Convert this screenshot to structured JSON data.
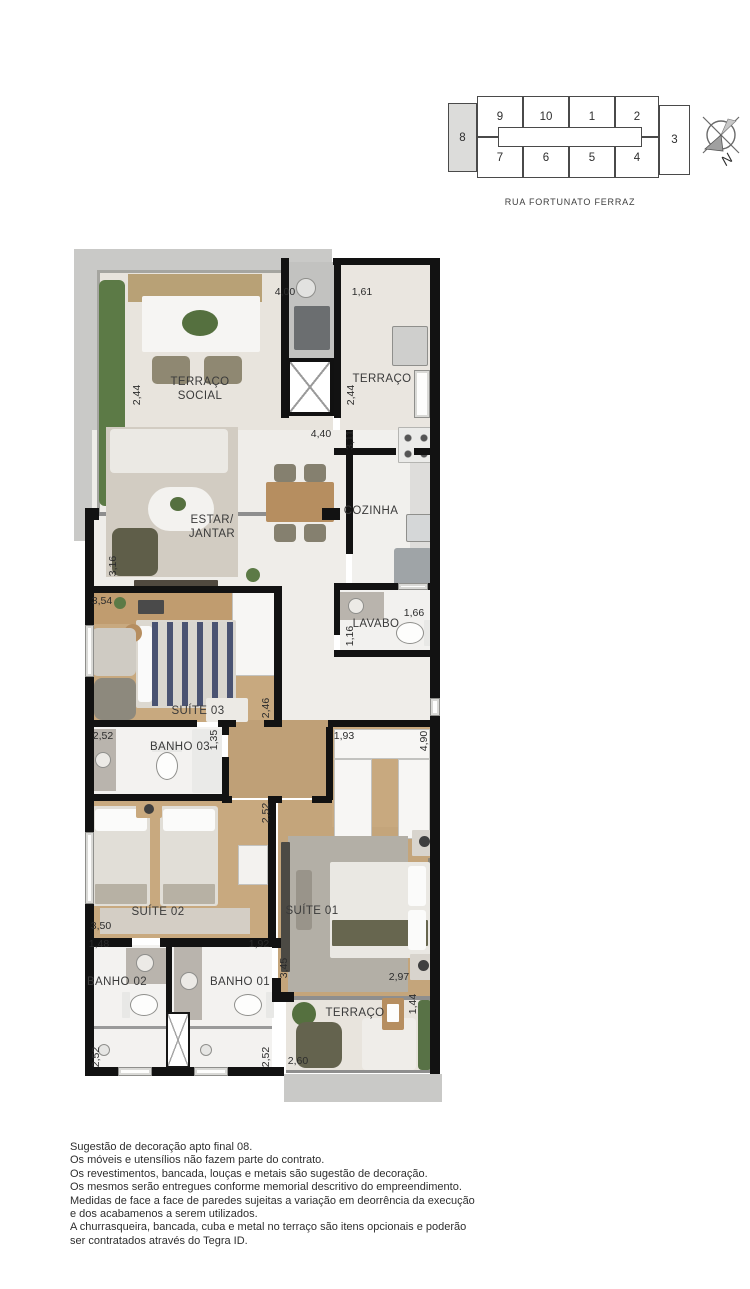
{
  "key_plan": {
    "street": "RUA FORTUNATO FERRAZ",
    "compass_label": "N",
    "highlighted_unit": "8",
    "cells": [
      {
        "label": "9",
        "x": 477,
        "y": 96,
        "w": 46,
        "h": 41,
        "hl": false
      },
      {
        "label": "10",
        "x": 523,
        "y": 96,
        "w": 46,
        "h": 41,
        "hl": false
      },
      {
        "label": "1",
        "x": 569,
        "y": 96,
        "w": 46,
        "h": 41,
        "hl": false
      },
      {
        "label": "2",
        "x": 615,
        "y": 96,
        "w": 44,
        "h": 41,
        "hl": false
      },
      {
        "label": "7",
        "x": 477,
        "y": 137,
        "w": 46,
        "h": 41,
        "hl": false
      },
      {
        "label": "6",
        "x": 523,
        "y": 137,
        "w": 46,
        "h": 41,
        "hl": false
      },
      {
        "label": "5",
        "x": 569,
        "y": 137,
        "w": 46,
        "h": 41,
        "hl": false
      },
      {
        "label": "4",
        "x": 615,
        "y": 137,
        "w": 44,
        "h": 41,
        "hl": false
      },
      {
        "label": "8",
        "x": 448,
        "y": 103,
        "w": 29,
        "h": 69,
        "hl": true
      },
      {
        "label": "3",
        "x": 659,
        "y": 105,
        "w": 31,
        "h": 70,
        "hl": false
      }
    ]
  },
  "floorplan": {
    "room_labels": [
      {
        "lines": [
          "TERRAÇO",
          "SOCIAL"
        ],
        "x": 200,
        "y": 390
      },
      {
        "lines": [
          "TERRAÇO"
        ],
        "x": 382,
        "y": 380
      },
      {
        "lines": [
          "ESTAR/",
          "JANTAR"
        ],
        "x": 212,
        "y": 528
      },
      {
        "lines": [
          "COZINHA"
        ],
        "x": 371,
        "y": 512
      },
      {
        "lines": [
          "LAVABO"
        ],
        "x": 376,
        "y": 625
      },
      {
        "lines": [
          "SUÍTE 03"
        ],
        "x": 198,
        "y": 712
      },
      {
        "lines": [
          "BANHO 03"
        ],
        "x": 180,
        "y": 748
      },
      {
        "lines": [
          "SUÍTE 02"
        ],
        "x": 158,
        "y": 913
      },
      {
        "lines": [
          "SUÍTE 01"
        ],
        "x": 312,
        "y": 912
      },
      {
        "lines": [
          "BANHO 02"
        ],
        "x": 117,
        "y": 983
      },
      {
        "lines": [
          "BANHO 01"
        ],
        "x": 240,
        "y": 983
      },
      {
        "lines": [
          "TERRAÇO"
        ],
        "x": 355,
        "y": 1014
      }
    ],
    "dim_labels": [
      {
        "t": "4,00",
        "x": 285,
        "y": 292,
        "v": false
      },
      {
        "t": "1,61",
        "x": 362,
        "y": 292,
        "v": false
      },
      {
        "t": "2,44",
        "x": 137,
        "y": 395,
        "v": true
      },
      {
        "t": "2,44",
        "x": 351,
        "y": 395,
        "v": true
      },
      {
        "t": "4,40",
        "x": 321,
        "y": 434,
        "v": false
      },
      {
        "t": "3,11",
        "x": 350,
        "y": 440,
        "v": true
      },
      {
        "t": "3,16",
        "x": 113,
        "y": 566,
        "v": true
      },
      {
        "t": "3,54",
        "x": 102,
        "y": 601,
        "v": false
      },
      {
        "t": "1,66",
        "x": 414,
        "y": 613,
        "v": false
      },
      {
        "t": "1,16",
        "x": 350,
        "y": 636,
        "v": true
      },
      {
        "t": "2,46",
        "x": 266,
        "y": 708,
        "v": true
      },
      {
        "t": "2,52",
        "x": 103,
        "y": 736,
        "v": false
      },
      {
        "t": "1,35",
        "x": 214,
        "y": 740,
        "v": true
      },
      {
        "t": "1,93",
        "x": 344,
        "y": 736,
        "v": false
      },
      {
        "t": "4,90",
        "x": 424,
        "y": 741,
        "v": true
      },
      {
        "t": "2,52",
        "x": 266,
        "y": 813,
        "v": true
      },
      {
        "t": "3,50",
        "x": 101,
        "y": 926,
        "v": false
      },
      {
        "t": "1,48",
        "x": 99,
        "y": 944,
        "v": false
      },
      {
        "t": "1,92",
        "x": 259,
        "y": 944,
        "v": false
      },
      {
        "t": "3,45",
        "x": 284,
        "y": 968,
        "v": true
      },
      {
        "t": "2,97",
        "x": 399,
        "y": 977,
        "v": false
      },
      {
        "t": "1,44",
        "x": 413,
        "y": 1004,
        "v": true
      },
      {
        "t": "2,60",
        "x": 298,
        "y": 1061,
        "v": false
      },
      {
        "t": "2,52",
        "x": 96,
        "y": 1057,
        "v": true
      },
      {
        "t": "2,52",
        "x": 266,
        "y": 1057,
        "v": true
      }
    ]
  },
  "notes": {
    "lines": [
      "Sugestão de decoração apto final 08.",
      "Os móveis e utensílios não fazem parte do contrato.",
      "Os revestimentos, bancada, louças e metais são sugestão de decoração.",
      "Os mesmos serão entregues conforme memorial descritivo do empreendimento.",
      "Medidas de face a face de paredes sujeitas a variação em deorrência da execução",
      "e dos acabamenos a serem utilizados.",
      "A churrasqueira, bancada, cuba e metal no terraço são itens opcionais e poderão",
      "ser contratados através do Tegra ID."
    ]
  }
}
